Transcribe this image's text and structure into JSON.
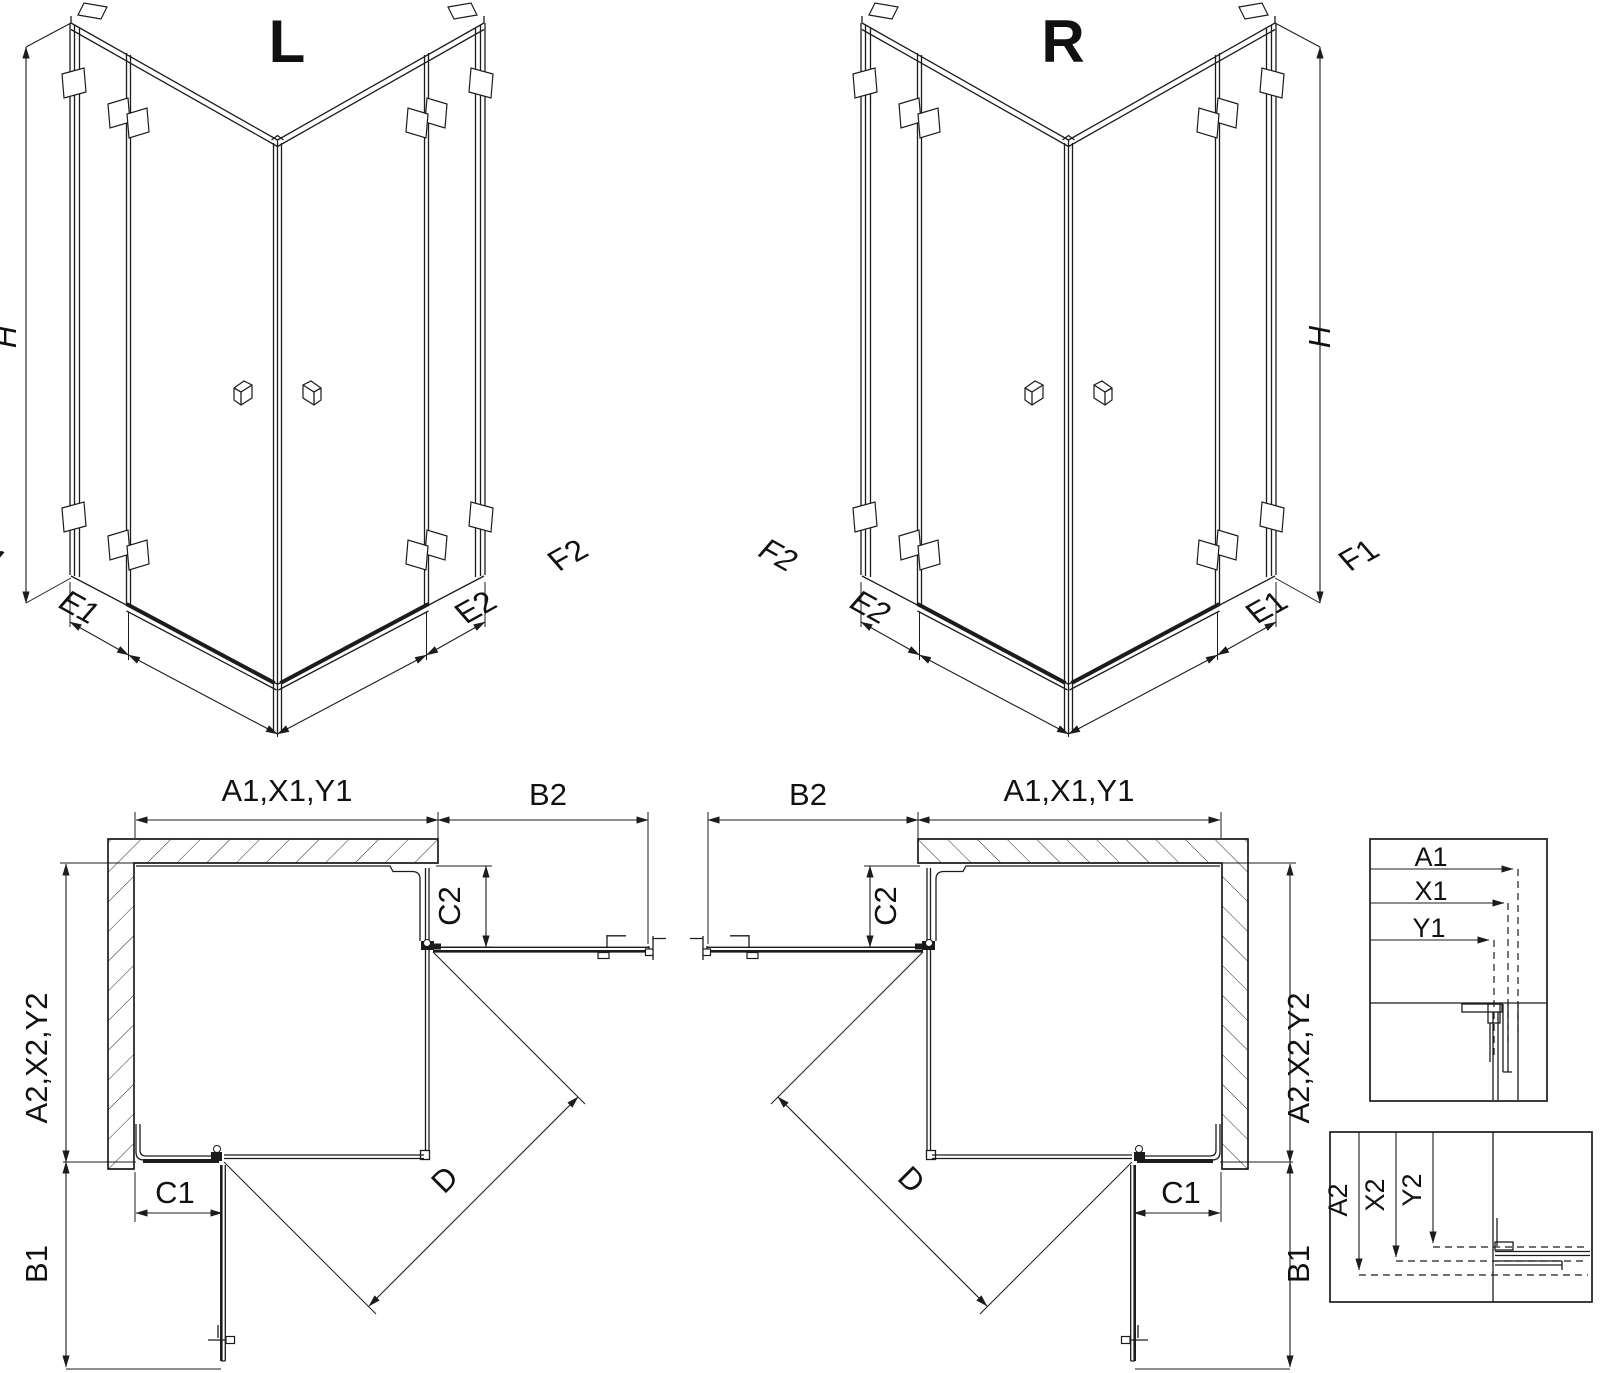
{
  "drawing": {
    "type": "shower-enclosure-technical-drawing",
    "colors": {
      "line": "#1c1c1c",
      "background": "#ffffff"
    },
    "iso_left": {
      "title": "L",
      "height": "H",
      "base_left": [
        "F1",
        "E1"
      ],
      "base_right": [
        "E2",
        "F2"
      ]
    },
    "iso_right": {
      "title": "R",
      "height": "H",
      "base_left": [
        "F2",
        "E2"
      ],
      "base_right": [
        "E1",
        "F1"
      ]
    },
    "plan_left": {
      "width_total": "A1,X1,Y1",
      "door_top": "B2",
      "fixed_right": "C2",
      "depth_total": "A2,X2,Y2",
      "fixed_bottom": "C1",
      "door_left": "B1",
      "diagonal": "D"
    },
    "plan_right": {
      "width_total": "A1,X1,Y1",
      "door_top": "B2",
      "fixed_left": "C2",
      "depth_total": "A2,X2,Y2",
      "fixed_bottom": "C1",
      "door_right": "B1",
      "diagonal": "D"
    },
    "detail_top": {
      "lines": [
        "A1",
        "X1",
        "Y1"
      ]
    },
    "detail_bottom": {
      "lines": [
        "A2",
        "X2",
        "Y2"
      ]
    }
  }
}
